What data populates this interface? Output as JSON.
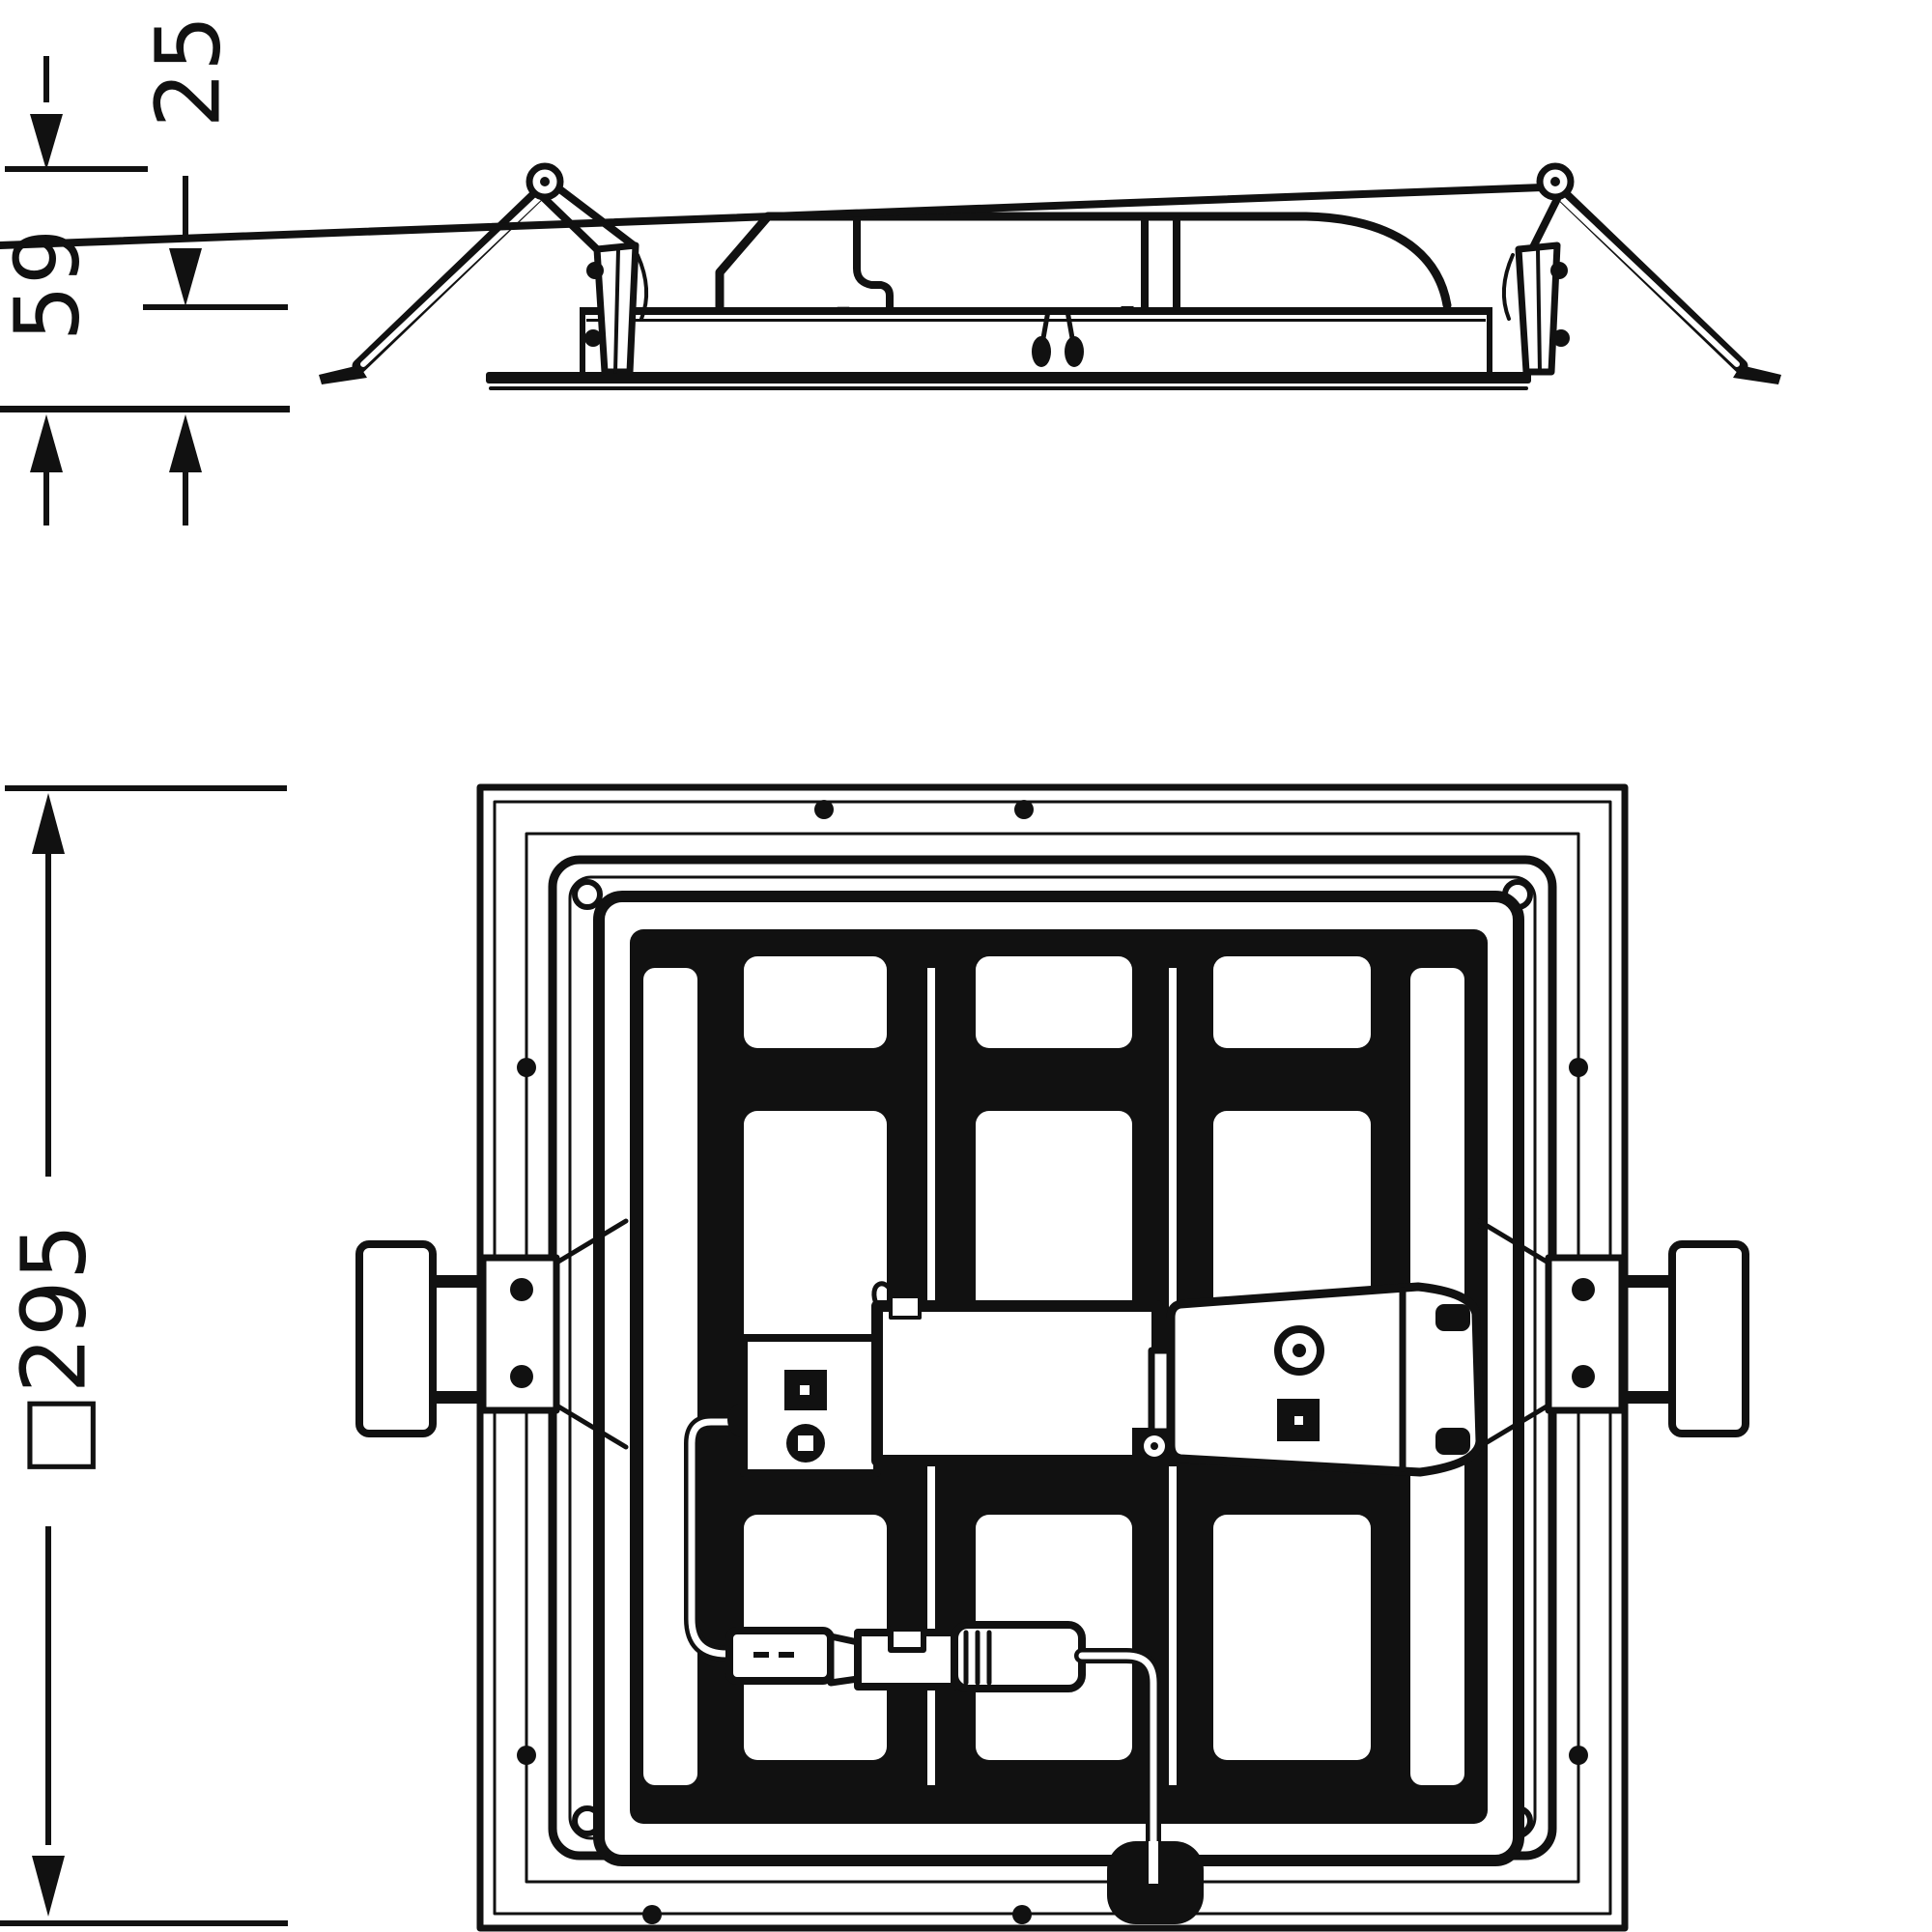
{
  "canvas": {
    "background": "#ffffff",
    "ink": "#111111"
  },
  "drawing": {
    "kind": "dimensioned technical line drawing",
    "subject": "square recessed LED panel luminaire",
    "views": [
      {
        "id": "side-elevation",
        "description": "side view of recessed housing with driver box and spring mounting clips"
      },
      {
        "id": "rear-plan",
        "description": "rear plan view of square frame with rib grid, driver, terminal box, plug connector pair and cabling"
      }
    ]
  },
  "dimensions": {
    "clip_height": {
      "value": "59",
      "measures": "ceiling plane to top of spring clip"
    },
    "housing_height": {
      "value": "25",
      "measures": "ceiling plane to top of housing"
    },
    "overall": {
      "value": "□295",
      "measures": "outer square size of trim frame"
    }
  }
}
